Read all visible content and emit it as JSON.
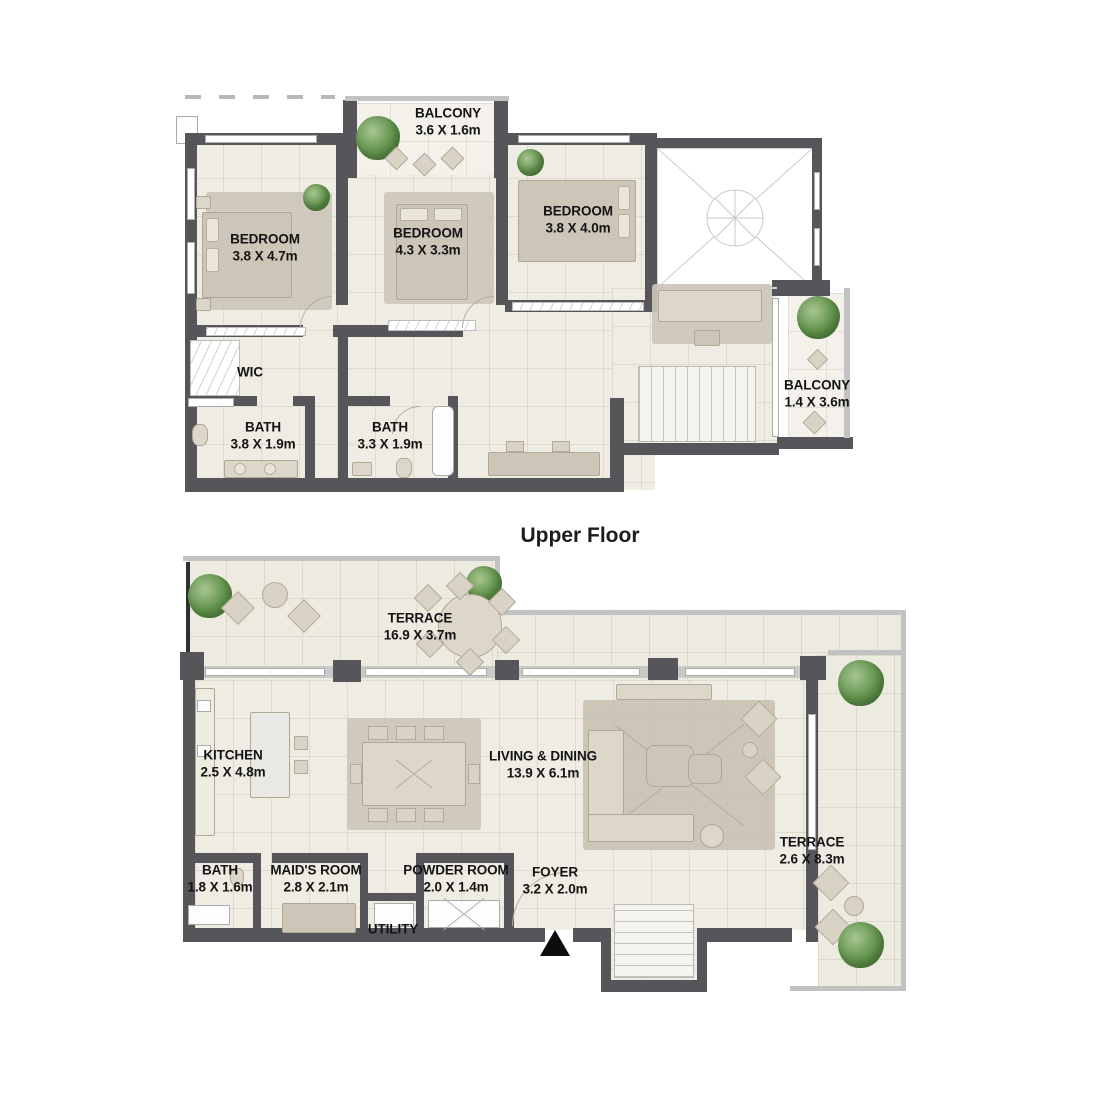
{
  "colors": {
    "wall": "#55555a",
    "floor": "#efece3",
    "terrace_floor": "#edeae0",
    "furniture": "#cdc5b7",
    "furniture_light": "#ddd7ca",
    "tree": "#5d8f48",
    "text": "#141414"
  },
  "upper_floor": {
    "caption": "Upper Floor",
    "rooms": {
      "bedroom_left": {
        "name": "BEDROOM",
        "dims": "3.8 X 4.7m"
      },
      "bedroom_middle": {
        "name": "BEDROOM",
        "dims": "4.3 X 3.3m"
      },
      "bedroom_right": {
        "name": "BEDROOM",
        "dims": "3.8 X 4.0m"
      },
      "balcony_top": {
        "name": "BALCONY",
        "dims": "3.6 X 1.6m"
      },
      "balcony_right": {
        "name": "BALCONY",
        "dims": "1.4 X 3.6m"
      },
      "wic": {
        "name": "WIC",
        "dims": ""
      },
      "bath_left": {
        "name": "BATH",
        "dims": "3.8 X 1.9m"
      },
      "bath_middle": {
        "name": "BATH",
        "dims": "3.3 X 1.9m"
      }
    }
  },
  "lower_floor": {
    "rooms": {
      "terrace_top": {
        "name": "TERRACE",
        "dims": "16.9 X 3.7m"
      },
      "kitchen": {
        "name": "KITCHEN",
        "dims": "2.5 X 4.8m"
      },
      "living_dining": {
        "name": "LIVING & DINING",
        "dims": "13.9 X 6.1m"
      },
      "terrace_right": {
        "name": "TERRACE",
        "dims": "2.6 X 8.3m"
      },
      "bath": {
        "name": "BATH",
        "dims": "1.8 X 1.6m"
      },
      "maids_room": {
        "name": "MAID'S ROOM",
        "dims": "2.8 X 2.1m"
      },
      "powder_room": {
        "name": "POWDER ROOM",
        "dims": "2.0 X 1.4m"
      },
      "foyer": {
        "name": "FOYER",
        "dims": "3.2 X 2.0m"
      },
      "utility": {
        "name": "UTILITY",
        "dims": ""
      }
    }
  }
}
